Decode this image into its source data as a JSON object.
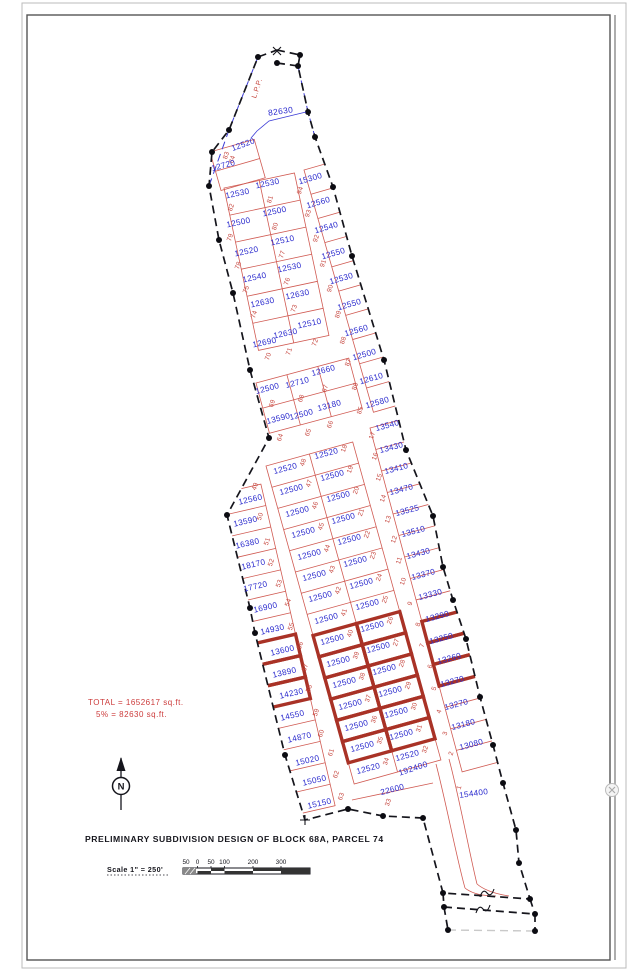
{
  "title": "PRELIMINARY SUBDIVISION DESIGN OF BLOCK 68A, PARCEL 74",
  "summary": {
    "line1": "TOTAL = 1652617 sq.ft.",
    "line2": "5% = 82630 sq.ft."
  },
  "scale": {
    "text": "Scale 1\" = 250'",
    "bar_ticks": [
      "50",
      "0",
      "50",
      "100",
      "200",
      "300"
    ]
  },
  "annotations": {
    "lpp": "L.P.P.",
    "reserve_area": "82630",
    "road_area": "192400",
    "north_letter": "N"
  },
  "colors": {
    "lot_text_blue": "#2b2bce",
    "lot_line_red": "#d05a52",
    "highlight_red": "#a93226",
    "note_red": "#cc3b3b",
    "boundary_black": "#15151c",
    "boundary_blue": "#3b3bd6"
  },
  "lots": [
    {
      "no": "84",
      "area": "12520",
      "ax": 244,
      "ay": 147,
      "ar": -20,
      "nx": 234,
      "ny": 160,
      "hl": false
    },
    {
      "no": "83",
      "area": "12720",
      "ax": 224,
      "ay": 168,
      "ar": -15,
      "nx": 228,
      "ny": 156,
      "hl": false
    },
    {
      "no": "82",
      "area": "12530",
      "ax": 238,
      "ay": 196,
      "ar": -12,
      "nx": 233,
      "ny": 208,
      "hl": false
    },
    {
      "no": "81",
      "area": "12530",
      "ax": 268,
      "ay": 186,
      "ar": -12,
      "nx": 272,
      "ny": 200,
      "hl": false
    },
    {
      "no": "79",
      "area": "12500",
      "ax": 239,
      "ay": 225,
      "ar": -12,
      "nx": 232,
      "ny": 238,
      "hl": false
    },
    {
      "no": "80",
      "area": "12500",
      "ax": 275,
      "ay": 214,
      "ar": -12,
      "nx": 277,
      "ny": 227,
      "hl": false
    },
    {
      "no": "78",
      "area": "12520",
      "ax": 247,
      "ay": 254,
      "ar": -12,
      "nx": 240,
      "ny": 266,
      "hl": false
    },
    {
      "no": "77",
      "area": "12510",
      "ax": 283,
      "ay": 243,
      "ar": -12,
      "nx": 284,
      "ny": 255,
      "hl": false
    },
    {
      "no": "75",
      "area": "12540",
      "ax": 255,
      "ay": 280,
      "ar": -12,
      "nx": 248,
      "ny": 290,
      "hl": false
    },
    {
      "no": "76",
      "area": "12530",
      "ax": 290,
      "ay": 270,
      "ar": -12,
      "nx": 289,
      "ny": 282,
      "hl": false
    },
    {
      "no": "74",
      "area": "12630",
      "ax": 263,
      "ay": 305,
      "ar": -12,
      "nx": 256,
      "ny": 315,
      "hl": false
    },
    {
      "no": "73",
      "area": "12630",
      "ax": 298,
      "ay": 297,
      "ar": -12,
      "nx": 296,
      "ny": 309,
      "hl": false
    },
    {
      "no": "70",
      "area": "12690",
      "ax": 265,
      "ay": 345,
      "ar": -12,
      "nx": 270,
      "ny": 357,
      "hl": false
    },
    {
      "no": "71",
      "area": "12630",
      "ax": 286,
      "ay": 336,
      "ar": -12,
      "nx": 291,
      "ny": 352,
      "hl": false
    },
    {
      "no": "72",
      "area": "12510",
      "ax": 310,
      "ay": 326,
      "ar": -12,
      "nx": 317,
      "ny": 343,
      "hl": false
    },
    {
      "no": "94",
      "area": "15300",
      "ax": 311,
      "ay": 181,
      "ar": -16,
      "nx": 302,
      "ny": 191,
      "hl": false
    },
    {
      "no": "93",
      "area": "12560",
      "ax": 319,
      "ay": 205,
      "ar": -16,
      "nx": 310,
      "ny": 214,
      "hl": false
    },
    {
      "no": "92",
      "area": "12540",
      "ax": 327,
      "ay": 230,
      "ar": -16,
      "nx": 318,
      "ny": 239,
      "hl": false
    },
    {
      "no": "91",
      "area": "12550",
      "ax": 334,
      "ay": 256,
      "ar": -16,
      "nx": 325,
      "ny": 264,
      "hl": false
    },
    {
      "no": "90",
      "area": "12530",
      "ax": 342,
      "ay": 281,
      "ar": -16,
      "nx": 332,
      "ny": 289,
      "hl": false
    },
    {
      "no": "89",
      "area": "12550",
      "ax": 350,
      "ay": 307,
      "ar": -16,
      "nx": 340,
      "ny": 315,
      "hl": false
    },
    {
      "no": "88",
      "area": "12560",
      "ax": 357,
      "ay": 333,
      "ar": -16,
      "nx": 345,
      "ny": 341,
      "hl": false
    },
    {
      "no": "87",
      "area": "12500",
      "ax": 365,
      "ay": 357,
      "ar": -16,
      "nx": 350,
      "ny": 363,
      "hl": false
    },
    {
      "no": "86",
      "area": "12610",
      "ax": 372,
      "ay": 381,
      "ar": -16,
      "nx": 357,
      "ny": 387,
      "hl": false
    },
    {
      "no": "85",
      "area": "12580",
      "ax": 378,
      "ay": 405,
      "ar": -16,
      "nx": 362,
      "ny": 411,
      "hl": false
    },
    {
      "no": "69",
      "area": "12500",
      "ax": 268,
      "ay": 391,
      "ar": -15,
      "nx": 274,
      "ny": 404,
      "hl": false
    },
    {
      "no": "68",
      "area": "12710",
      "ax": 298,
      "ay": 385,
      "ar": -15,
      "nx": 303,
      "ny": 399,
      "hl": false
    },
    {
      "no": "67",
      "area": "12660",
      "ax": 324,
      "ay": 373,
      "ar": -15,
      "nx": 327,
      "ny": 389,
      "hl": false
    },
    {
      "no": "64",
      "area": "13590",
      "ax": 279,
      "ay": 421,
      "ar": -15,
      "nx": 282,
      "ny": 438,
      "hl": false
    },
    {
      "no": "65",
      "area": "12500",
      "ax": 302,
      "ay": 417,
      "ar": -15,
      "nx": 310,
      "ny": 433,
      "hl": false
    },
    {
      "no": "66",
      "area": "13180",
      "ax": 330,
      "ay": 408,
      "ar": -15,
      "nx": 332,
      "ny": 425,
      "hl": false
    },
    {
      "no": "49",
      "area": "12560",
      "ax": 251,
      "ay": 502,
      "ar": -13,
      "nx": 257,
      "ny": 487,
      "hl": false
    },
    {
      "no": "50",
      "area": "13590",
      "ax": 246,
      "ay": 524,
      "ar": -13,
      "nx": 262,
      "ny": 517,
      "hl": false
    },
    {
      "no": "51",
      "area": "16380",
      "ax": 248,
      "ay": 546,
      "ar": -13,
      "nx": 269,
      "ny": 542,
      "hl": false
    },
    {
      "no": "52",
      "area": "18170",
      "ax": 254,
      "ay": 567,
      "ar": -13,
      "nx": 273,
      "ny": 563,
      "hl": false
    },
    {
      "no": "53",
      "area": "17720",
      "ax": 256,
      "ay": 589,
      "ar": -13,
      "nx": 281,
      "ny": 584,
      "hl": false
    },
    {
      "no": "54",
      "area": "16900",
      "ax": 266,
      "ay": 610,
      "ar": -13,
      "nx": 290,
      "ny": 603,
      "hl": false
    },
    {
      "no": "55",
      "area": "14930",
      "ax": 273,
      "ay": 632,
      "ar": -13,
      "nx": 293,
      "ny": 627,
      "hl": false
    },
    {
      "no": "56",
      "area": "13600",
      "ax": 283,
      "ay": 653,
      "ar": -13,
      "nx": 302,
      "ny": 646,
      "hl": true
    },
    {
      "no": "57",
      "area": "13890",
      "ax": 285,
      "ay": 675,
      "ar": -13,
      "nx": 307,
      "ny": 668,
      "hl": true
    },
    {
      "no": "58",
      "area": "14230",
      "ax": 292,
      "ay": 696,
      "ar": -13,
      "nx": 311,
      "ny": 689,
      "hl": true
    },
    {
      "no": "59",
      "area": "14550",
      "ax": 293,
      "ay": 718,
      "ar": -13,
      "nx": 318,
      "ny": 713,
      "hl": false
    },
    {
      "no": "60",
      "area": "14870",
      "ax": 300,
      "ay": 740,
      "ar": -13,
      "nx": 323,
      "ny": 734,
      "hl": false
    },
    {
      "no": "61",
      "area": "15020",
      "ax": 308,
      "ay": 763,
      "ar": -13,
      "nx": 333,
      "ny": 753,
      "hl": false
    },
    {
      "no": "62",
      "area": "15050",
      "ax": 315,
      "ay": 783,
      "ar": -13,
      "nx": 338,
      "ny": 775,
      "hl": false
    },
    {
      "no": "63",
      "area": "15150",
      "ax": 320,
      "ay": 806,
      "ar": -13,
      "nx": 343,
      "ny": 797,
      "hl": false
    },
    {
      "no": "48",
      "area": "12520",
      "ax": 286,
      "ay": 471,
      "ar": -15,
      "nx": 305,
      "ny": 463,
      "hl": false
    },
    {
      "no": "47",
      "area": "12500",
      "ax": 292,
      "ay": 492,
      "ar": -15,
      "nx": 311,
      "ny": 484,
      "hl": false
    },
    {
      "no": "46",
      "area": "12500",
      "ax": 298,
      "ay": 514,
      "ar": -15,
      "nx": 317,
      "ny": 506,
      "hl": false
    },
    {
      "no": "45",
      "area": "12500",
      "ax": 304,
      "ay": 535,
      "ar": -15,
      "nx": 323,
      "ny": 527,
      "hl": false
    },
    {
      "no": "44",
      "area": "12500",
      "ax": 310,
      "ay": 557,
      "ar": -15,
      "nx": 329,
      "ny": 549,
      "hl": false
    },
    {
      "no": "43",
      "area": "12500",
      "ax": 315,
      "ay": 578,
      "ar": -15,
      "nx": 334,
      "ny": 570,
      "hl": false
    },
    {
      "no": "42",
      "area": "12500",
      "ax": 321,
      "ay": 599,
      "ar": -15,
      "nx": 340,
      "ny": 591,
      "hl": false
    },
    {
      "no": "41",
      "area": "12500",
      "ax": 327,
      "ay": 621,
      "ar": -15,
      "nx": 346,
      "ny": 613,
      "hl": false
    },
    {
      "no": "40",
      "area": "12500",
      "ax": 333,
      "ay": 642,
      "ar": -15,
      "nx": 352,
      "ny": 634,
      "hl": true
    },
    {
      "no": "39",
      "area": "12500",
      "ax": 339,
      "ay": 664,
      "ar": -15,
      "nx": 358,
      "ny": 656,
      "hl": true
    },
    {
      "no": "38",
      "area": "12500",
      "ax": 345,
      "ay": 685,
      "ar": -15,
      "nx": 364,
      "ny": 677,
      "hl": true
    },
    {
      "no": "37",
      "area": "12500",
      "ax": 351,
      "ay": 707,
      "ar": -15,
      "nx": 370,
      "ny": 699,
      "hl": true
    },
    {
      "no": "36",
      "area": "12500",
      "ax": 357,
      "ay": 728,
      "ar": -15,
      "nx": 376,
      "ny": 720,
      "hl": true
    },
    {
      "no": "35",
      "area": "12500",
      "ax": 363,
      "ay": 749,
      "ar": -15,
      "nx": 382,
      "ny": 741,
      "hl": true
    },
    {
      "no": "34",
      "area": "12520",
      "ax": 369,
      "ay": 771,
      "ar": -15,
      "nx": 388,
      "ny": 762,
      "hl": false
    },
    {
      "no": "33",
      "area": "22600",
      "ax": 393,
      "ay": 792,
      "ar": -15,
      "nx": 390,
      "ny": 803,
      "hl": false
    },
    {
      "no": "18",
      "area": "12520",
      "ax": 327,
      "ay": 456,
      "ar": -15,
      "nx": 346,
      "ny": 449,
      "hl": false
    },
    {
      "no": "19",
      "area": "12500",
      "ax": 333,
      "ay": 478,
      "ar": -15,
      "nx": 352,
      "ny": 470,
      "hl": false
    },
    {
      "no": "20",
      "area": "12500",
      "ax": 339,
      "ay": 499,
      "ar": -15,
      "nx": 358,
      "ny": 491,
      "hl": false
    },
    {
      "no": "21",
      "area": "12500",
      "ax": 344,
      "ay": 521,
      "ar": -15,
      "nx": 363,
      "ny": 513,
      "hl": false
    },
    {
      "no": "22",
      "area": "12500",
      "ax": 350,
      "ay": 542,
      "ar": -15,
      "nx": 369,
      "ny": 535,
      "hl": false
    },
    {
      "no": "23",
      "area": "12500",
      "ax": 356,
      "ay": 564,
      "ar": -15,
      "nx": 375,
      "ny": 556,
      "hl": false
    },
    {
      "no": "24",
      "area": "12500",
      "ax": 362,
      "ay": 586,
      "ar": -15,
      "nx": 381,
      "ny": 578,
      "hl": false
    },
    {
      "no": "25",
      "area": "12500",
      "ax": 368,
      "ay": 607,
      "ar": -15,
      "nx": 387,
      "ny": 600,
      "hl": false
    },
    {
      "no": "26",
      "area": "12500",
      "ax": 373,
      "ay": 629,
      "ar": -15,
      "nx": 392,
      "ny": 621,
      "hl": true
    },
    {
      "no": "27",
      "area": "12500",
      "ax": 379,
      "ay": 650,
      "ar": -15,
      "nx": 398,
      "ny": 643,
      "hl": true
    },
    {
      "no": "28",
      "area": "12500",
      "ax": 385,
      "ay": 672,
      "ar": -15,
      "nx": 404,
      "ny": 664,
      "hl": true
    },
    {
      "no": "29",
      "area": "12500",
      "ax": 391,
      "ay": 694,
      "ar": -15,
      "nx": 410,
      "ny": 686,
      "hl": true
    },
    {
      "no": "30",
      "area": "12500",
      "ax": 397,
      "ay": 715,
      "ar": -15,
      "nx": 416,
      "ny": 707,
      "hl": true
    },
    {
      "no": "31",
      "area": "12500",
      "ax": 402,
      "ay": 737,
      "ar": -15,
      "nx": 421,
      "ny": 729,
      "hl": true
    },
    {
      "no": "32",
      "area": "12520",
      "ax": 408,
      "ay": 758,
      "ar": -15,
      "nx": 427,
      "ny": 750,
      "hl": false
    },
    {
      "no": "17",
      "area": "13540",
      "ax": 388,
      "ay": 428,
      "ar": -15,
      "nx": 374,
      "ny": 436,
      "hl": false
    },
    {
      "no": "16",
      "area": "13430",
      "ax": 392,
      "ay": 450,
      "ar": -15,
      "nx": 377,
      "ny": 457,
      "hl": false
    },
    {
      "no": "15",
      "area": "13410",
      "ax": 397,
      "ay": 471,
      "ar": -15,
      "nx": 381,
      "ny": 478,
      "hl": false
    },
    {
      "no": "14",
      "area": "13470",
      "ax": 402,
      "ay": 492,
      "ar": -15,
      "nx": 385,
      "ny": 499,
      "hl": false
    },
    {
      "no": "13",
      "area": "13525",
      "ax": 408,
      "ay": 513,
      "ar": -15,
      "nx": 390,
      "ny": 520,
      "hl": false
    },
    {
      "no": "12",
      "area": "13510",
      "ax": 414,
      "ay": 534,
      "ar": -15,
      "nx": 396,
      "ny": 540,
      "hl": false
    },
    {
      "no": "11",
      "area": "13430",
      "ax": 419,
      "ay": 556,
      "ar": -15,
      "nx": 401,
      "ny": 561,
      "hl": false
    },
    {
      "no": "10",
      "area": "13370",
      "ax": 424,
      "ay": 577,
      "ar": -15,
      "nx": 405,
      "ny": 582,
      "hl": false
    },
    {
      "no": "9",
      "area": "13330",
      "ax": 431,
      "ay": 597,
      "ar": -15,
      "nx": 412,
      "ny": 604,
      "hl": false
    },
    {
      "no": "8",
      "area": "13290",
      "ax": 438,
      "ay": 619,
      "ar": -15,
      "nx": 420,
      "ny": 625,
      "hl": true
    },
    {
      "no": "7",
      "area": "13250",
      "ax": 442,
      "ay": 641,
      "ar": -15,
      "nx": 424,
      "ny": 646,
      "hl": true
    },
    {
      "no": "6",
      "area": "13260",
      "ax": 450,
      "ay": 661,
      "ar": -15,
      "nx": 432,
      "ny": 667,
      "hl": true
    },
    {
      "no": "5",
      "area": "13270",
      "ax": 453,
      "ay": 684,
      "ar": -15,
      "nx": 436,
      "ny": 689,
      "hl": false
    },
    {
      "no": "4",
      "area": "13270",
      "ax": 457,
      "ay": 707,
      "ar": -15,
      "nx": 441,
      "ny": 712,
      "hl": false
    },
    {
      "no": "3",
      "area": "13180",
      "ax": 464,
      "ay": 727,
      "ar": -15,
      "nx": 447,
      "ny": 734,
      "hl": false
    },
    {
      "no": "2",
      "area": "13080",
      "ax": 472,
      "ay": 747,
      "ar": -15,
      "nx": 453,
      "ny": 754,
      "hl": false
    },
    {
      "no": "1",
      "area": "154400",
      "ax": 474,
      "ay": 796,
      "ar": -8,
      "nx": 461,
      "ny": 788,
      "hl": false
    }
  ]
}
